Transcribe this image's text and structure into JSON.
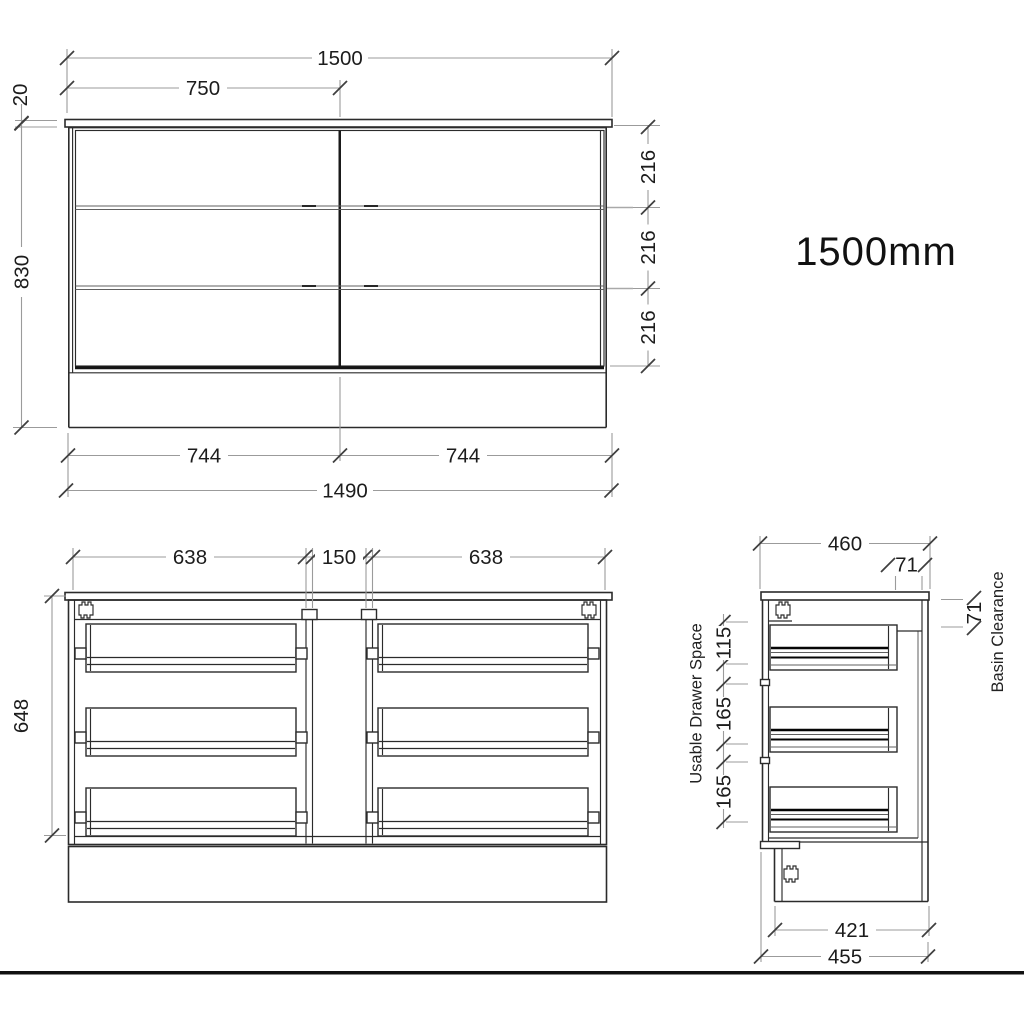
{
  "size_title": "1500mm",
  "front_view": {
    "overall_width": "1500",
    "half_width": "750",
    "top_thickness": "20",
    "height": "830",
    "drawer_heights": [
      "216",
      "216",
      "216"
    ],
    "drawer_widths": [
      "744",
      "744"
    ],
    "carcass_width": "1490"
  },
  "internal_view": {
    "left_drawer_width": "638",
    "center_gap": "150",
    "right_drawer_width": "638",
    "inner_height": "648"
  },
  "side_view": {
    "depth": "460",
    "rear_offset": "71",
    "basin_clearance": "71",
    "basin_clearance_label": "Basin Clearance",
    "usable_drawer_space_label": "Usable Drawer Space",
    "drawer_depths": [
      "115",
      "165",
      "165"
    ],
    "kickboard_depth": "421",
    "base_depth": "455"
  }
}
